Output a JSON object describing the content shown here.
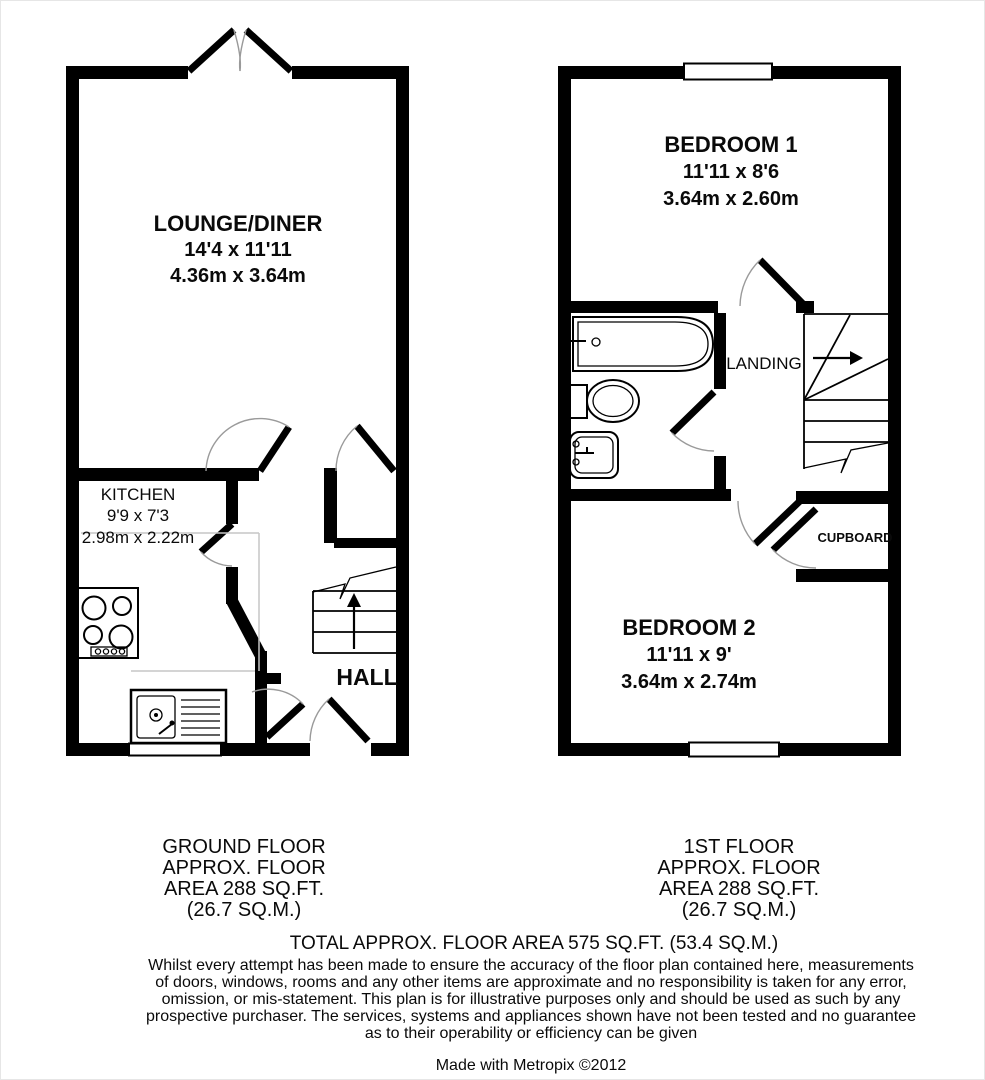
{
  "colors": {
    "wall": "#000000",
    "background": "#ffffff",
    "door_swing": "#9a9a9a",
    "counter_line": "#c6c6c6"
  },
  "ground_floor": {
    "rooms": {
      "lounge": {
        "name": "LOUNGE/DINER",
        "imperial": "14'4 x 11'11",
        "metric": "4.36m x 3.64m"
      },
      "kitchen": {
        "name": "KITCHEN",
        "imperial": "9'9 x 7'3",
        "metric": "2.98m x 2.22m"
      },
      "hall": {
        "name": "HALL"
      }
    },
    "caption": [
      "GROUND FLOOR",
      "APPROX. FLOOR",
      "AREA 288 SQ.FT.",
      "(26.7 SQ.M.)"
    ]
  },
  "first_floor": {
    "rooms": {
      "bedroom1": {
        "name": "BEDROOM 1",
        "imperial": "11'11 x 8'6",
        "metric": "3.64m x 2.60m"
      },
      "bedroom2": {
        "name": "BEDROOM 2",
        "imperial": "11'11 x 9'",
        "metric": "3.64m x 2.74m"
      },
      "landing": {
        "name": "LANDING"
      },
      "cupboard": {
        "name": "CUPBOARD"
      }
    },
    "caption": [
      "1ST FLOOR",
      "APPROX. FLOOR",
      "AREA 288 SQ.FT.",
      "(26.7 SQ.M.)"
    ]
  },
  "footer": {
    "total": "TOTAL APPROX. FLOOR AREA 575 SQ.FT. (53.4 SQ.M.)",
    "disclaimer": [
      "Whilst every attempt has been made to ensure the accuracy of the floor plan contained here, measurements",
      "of doors, windows, rooms and any other items are approximate and no responsibility is taken for any error,",
      "omission, or mis-statement. This plan is for illustrative purposes only and should be used as such by any",
      "prospective purchaser. The services, systems and appliances shown have not been tested and no guarantee",
      "as to their operability or efficiency can be given"
    ],
    "credit": "Made with Metropix ©2012"
  }
}
